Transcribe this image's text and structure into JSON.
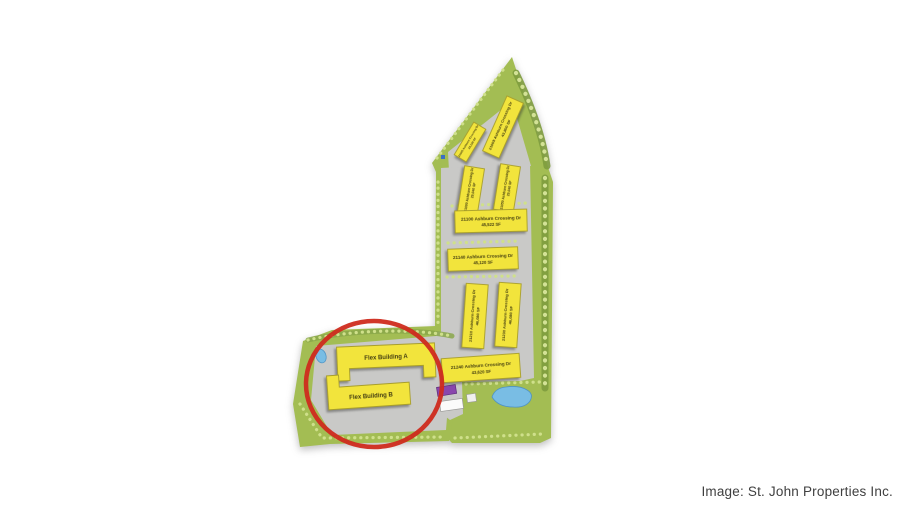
{
  "caption": {
    "text": "Image: St. John Properties Inc."
  },
  "map": {
    "buildings": [
      {
        "label": "21045 Ashburn Crossing Dr",
        "sf": "23,120 SF"
      },
      {
        "label": "21005 Ashburn Crossing Dr",
        "sf": "43,800 SF"
      },
      {
        "label": "21000 Ashburn Crossing Dr",
        "sf": "29,040 SF"
      },
      {
        "label": "21050 Ashburn Crossing Dr",
        "sf": "29,040 SF"
      },
      {
        "label": "21100 Ashburn Crossing Dr",
        "sf": "45,522 SF"
      },
      {
        "label": "21140 Ashburn Crossing Dr",
        "sf": "45,120 SF"
      },
      {
        "label": "21210 Ashburn Crossing Dr",
        "sf": "46,080 SF"
      },
      {
        "label": "21230 Ashburn Crossing Dr",
        "sf": "46,080 SF"
      },
      {
        "label": "21240 Ashburn Crossing Dr",
        "sf": "43,620 SF"
      },
      {
        "label": "Flex Building A",
        "sf": ""
      },
      {
        "label": "Flex Building B",
        "sf": ""
      }
    ],
    "colors": {
      "highlight_red": "#cf2b1e",
      "building_yellow": "#f2e43c",
      "terrain_green": "#a3bd53",
      "parking_gray": "#c9c9c7",
      "pond_blue": "#79bde4",
      "purple_building": "#8a46ad"
    }
  }
}
